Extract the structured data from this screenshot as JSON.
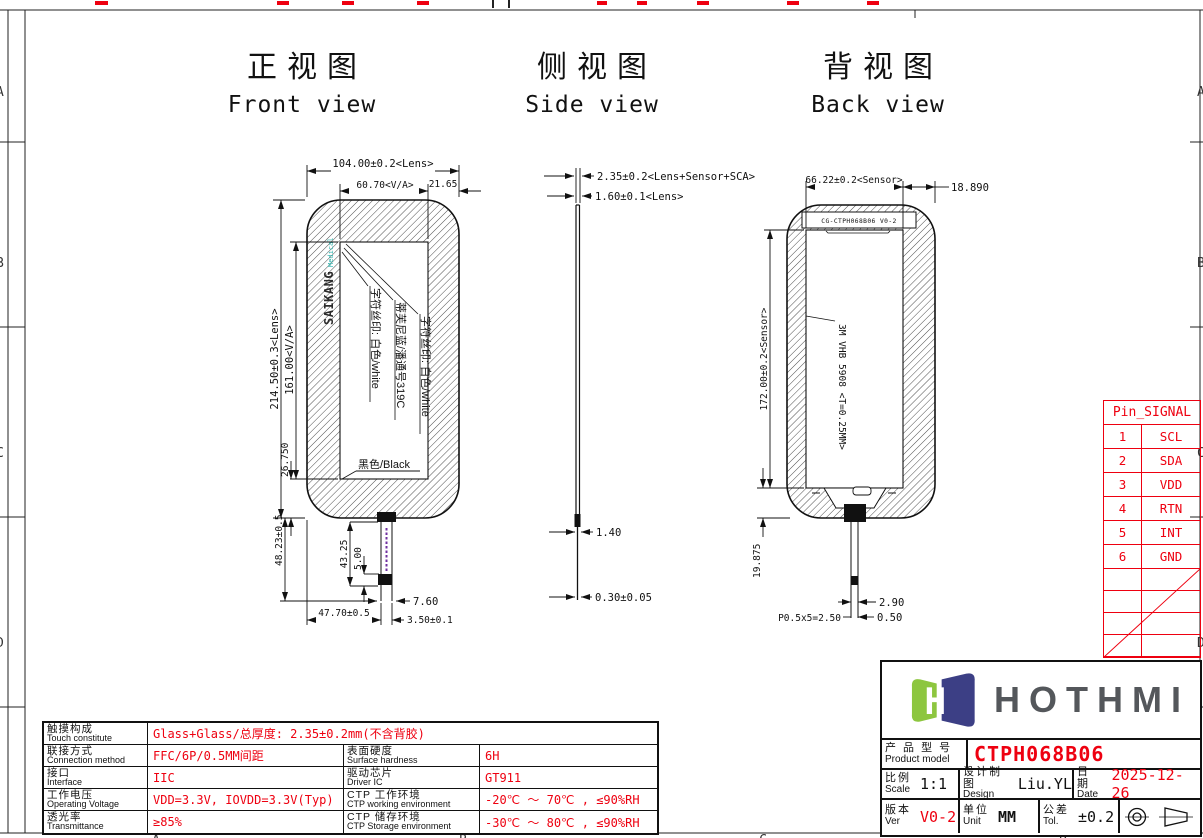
{
  "colors": {
    "red": "#ee0010",
    "teal": "#2bb3ad",
    "logo_green": "#8dc63f",
    "logo_navy": "#3c3f85",
    "ink": "#111111",
    "purple": "#7030a0"
  },
  "titles": {
    "front_cn": "正视图",
    "front_en": "Front view",
    "side_cn": "侧视图",
    "side_en": "Side view",
    "back_cn": "背视图",
    "back_en": "Back view"
  },
  "front": {
    "dim_width_lens": "104.00±0.2<Lens>",
    "dim_width_va": "60.70<V/A>",
    "dim_width_right": "21.65",
    "dim_height_lens": "214.50±0.3<Lens>",
    "dim_height_va": "161.00<V/A>",
    "dim_corner": "26.750",
    "dim_tail_total": "48.23±0.5",
    "dim_tail_len": "43.25",
    "dim_stiffener": "5.00",
    "dim_tail_width": "7.60",
    "dim_tail_offset": "47.70±0.5",
    "dim_tail_tol": "3.50±0.1",
    "logo_main": "SAIKANG",
    "logo_sub": "Medical",
    "label_silk1": "字符丝印: 白色/white",
    "label_color": "蒂芙尼蓝/潘通号319C",
    "label_silk2": "字符丝印: 白色/white",
    "label_bg": "黑色/Black"
  },
  "side": {
    "dim_total": "2.35±0.2<Lens+Sensor+SCA>",
    "dim_lens": "1.60±0.1<Lens>",
    "dim_fpc": "1.40",
    "dim_tail": "0.30±0.05"
  },
  "back": {
    "marking": "CG-CTPH068B06 V0-2",
    "tape": "3M VHB 5908 <T=0.25MM>",
    "dim_sensor_w": "66.22±0.2<Sensor>",
    "dim_right": "18.890",
    "dim_sensor_h": "172.00±0.2<Sensor>",
    "dim_bottom": "19.875",
    "dim_tail_w": "2.90",
    "dim_pitch": "P0.5x5=2.50",
    "dim_tail_t": "0.50"
  },
  "pin_table": {
    "title": "Pin_SIGNAL",
    "rows": [
      [
        "1",
        "SCL"
      ],
      [
        "2",
        "SDA"
      ],
      [
        "3",
        "VDD"
      ],
      [
        "4",
        "RTN"
      ],
      [
        "5",
        "INT"
      ],
      [
        "6",
        "GND"
      ]
    ]
  },
  "title_block": {
    "brand": "HOTHMI",
    "product_cn": "产 品 型 号",
    "product_en": "Product model",
    "product_value": "CTPH068B06",
    "scale_cn": "比例",
    "scale_en": "Scale",
    "scale_value": "1:1",
    "design_cn": "设计制图",
    "design_en": "Design",
    "design_value": "Liu.YL",
    "date_cn": "日期",
    "date_en": "Date",
    "date_value": "2025-12-26",
    "ver_cn": "版本",
    "ver_en": "Ver",
    "ver_value": "V0-2",
    "unit_cn": "单位",
    "unit_en": "Unit",
    "unit_value": "MM",
    "tol_cn": "公差",
    "tol_en": "Tol.",
    "tol_value": "±0.2"
  },
  "spec_table": {
    "rows": [
      {
        "label_cn": "触摸构成",
        "label_en": "Touch constitute",
        "value": "Glass+Glass/总厚度: 2.35±0.2mm(不含背胶)"
      },
      {
        "label_cn": "联接方式",
        "label_en": "Connection method",
        "value": "FFC/6P/0.5MM间距",
        "label2_cn": "表面硬度",
        "label2_en": "Surface hardness",
        "value2": "6H"
      },
      {
        "label_cn": "接口",
        "label_en": "Interface",
        "value": "IIC",
        "label2_cn": "驱动芯片",
        "label2_en": "Driver IC",
        "value2": "GT911"
      },
      {
        "label_cn": "工作电压",
        "label_en": "Operating Voltage",
        "value": "VDD=3.3V, IOVDD=3.3V(Typ)",
        "label2_cn": "CTP 工作环境",
        "label2_en": "CTP working environment",
        "value2": "-20℃ ～ 70℃ , ≤90%RH"
      },
      {
        "label_cn": "透光率",
        "label_en": "Transmittance",
        "value": "≥85%",
        "label2_cn": "CTP 储存环境",
        "label2_en": "CTP Storage environment",
        "value2": "-30℃ ～ 80℃ , ≤90%RH"
      }
    ]
  },
  "frame": {
    "left_letters": [
      "A",
      "B",
      "C",
      "D"
    ],
    "right_letters": [
      "A",
      "B",
      "C",
      "D"
    ],
    "bottom_letters": [
      "A",
      "B",
      "C",
      "D"
    ]
  }
}
